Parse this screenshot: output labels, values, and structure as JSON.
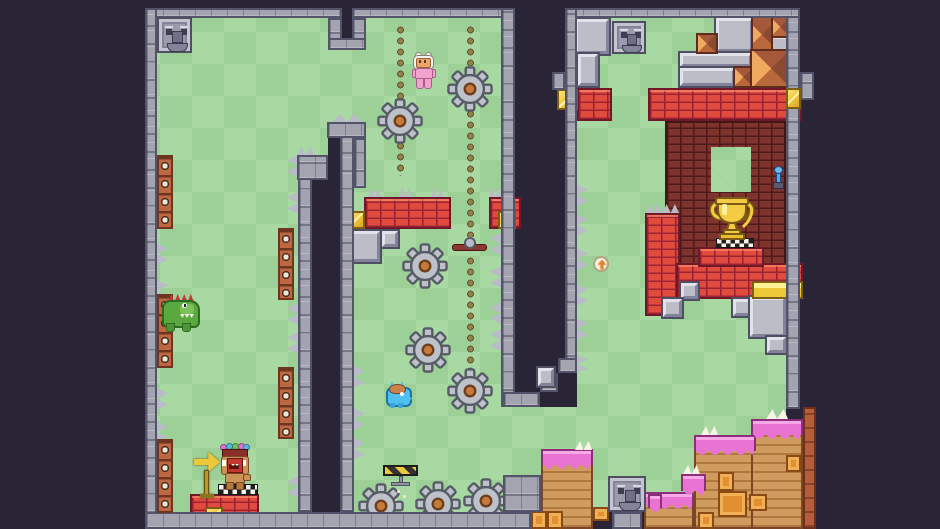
{
  "meta": {
    "description": "2D pixel-art platformer level screenshot, no HUD text visible"
  },
  "viewport": {
    "width": 940,
    "height": 529
  },
  "palette": {
    "background": "#2a2437",
    "grass_light": "#a9d9a2",
    "grass_dark": "#9cd096",
    "wall_stone": "#a3a4b0",
    "brick_red": "#e14b3e",
    "brick_maroon": "#7e332d",
    "gold": "#f1c83e",
    "dirt": "#d09b5f",
    "icing_pink": "#e873d2",
    "gear_gray": "#bdc1ca",
    "gear_hub": "#c67b3b",
    "crate_orange": "#e2902f",
    "crate_wall": "#bd6843",
    "track_dot": "#93804a",
    "crocodile_green": "#5aa93e",
    "player_pink": "#f2a3cb",
    "hopper_blue": "#4fc0ee"
  },
  "entities": {
    "player": {
      "label": "Pink bunny-suit explorer",
      "x": 414,
      "y": 53
    },
    "crocodile": {
      "label": "Crocodile enemy",
      "x": 161,
      "y": 293
    },
    "hopper": {
      "label": "Blue hopper enemy",
      "x": 386,
      "y": 382
    },
    "totem": {
      "label": "Crowned totem idol on start pedestal",
      "x": 218,
      "y": 445
    },
    "trophy": {
      "label": "Gold trophy goal on checkered pedestal",
      "x": 706,
      "y": 196
    },
    "arrow_sign": {
      "label": "Yellow arrow sign pointing right",
      "x": 195,
      "y": 451
    },
    "jump_badge": {
      "label": "Jump arrow badge pickup",
      "x": 593,
      "y": 256
    },
    "lever": {
      "label": "Blue wall lever",
      "x": 773,
      "y": 166
    },
    "coin_block": {
      "label": "Gold coin block",
      "count": 7
    },
    "gold_bar": {
      "label": "Large gold bar",
      "count": 1
    },
    "gear": {
      "label": "Rotating saw gear hazard",
      "count": 8
    },
    "gear_track": {
      "label": "Dotted gear track",
      "count": 2
    },
    "propeller": {
      "label": "Propeller bar obstacle",
      "x": 452,
      "y": 237
    },
    "crusher": {
      "label": "Striped hazard platform",
      "x": 383,
      "y": 465
    },
    "spikes": {
      "label": "Stone wall spikes"
    },
    "face_block": {
      "label": "Carved stone face block",
      "count": 3
    }
  }
}
